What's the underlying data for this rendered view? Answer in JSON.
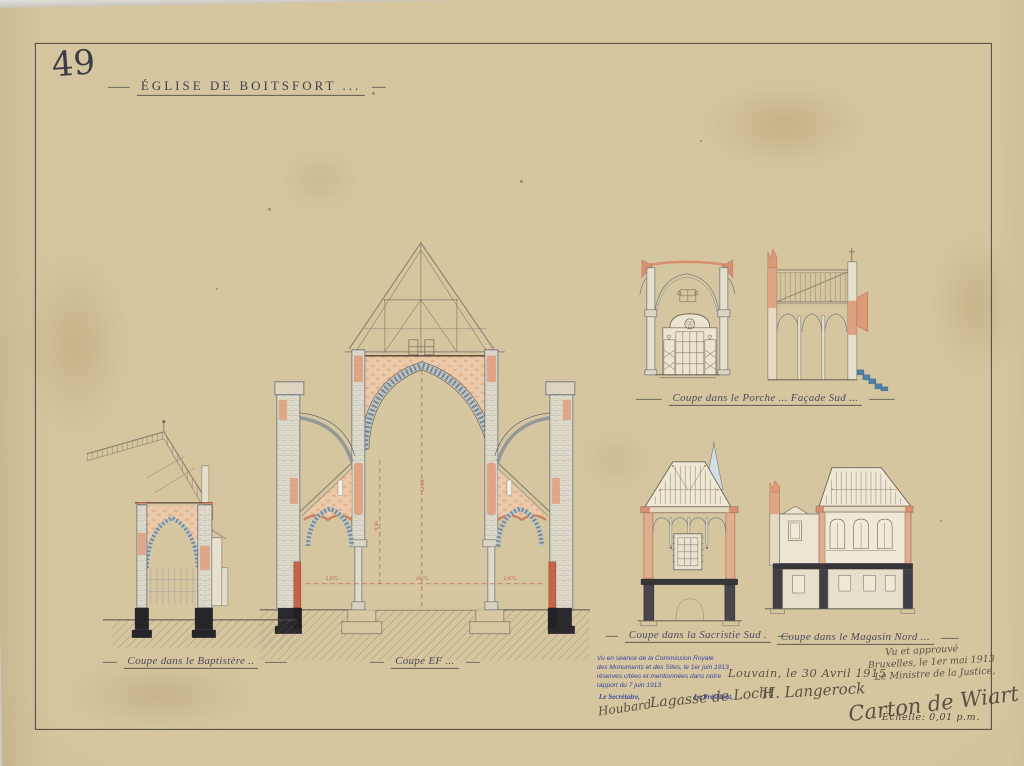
{
  "sheet": {
    "number": "49",
    "title": "Église de Boitsfort ...",
    "scale_label": "Échelle: 0,01 p.m."
  },
  "captions": {
    "baptistere": "Coupe dans le Baptistère ..",
    "coupe_ef": "Coupe EF ...",
    "porche": "Coupe dans le Porche ... Façade Sud ...",
    "sacristie": "Coupe dans la Sacristie Sud .",
    "magasin": "Coupe dans le Magasin Nord ..."
  },
  "dimensions": {
    "nave_left": "5,075",
    "nave_center": "10,75",
    "nave_right": "5,075",
    "aisle_height": "9,50",
    "nave_height": "12,60"
  },
  "stamp": {
    "line1": "Vu en séance de la Commission Royale",
    "line2": "des Monuments et des Sites, le 1er juin 1913",
    "line3": "réserves citées et mentionnées dans notre",
    "line4": "rapport du 7 juin 1913",
    "secretary_label": "Le Secrétaire,",
    "president_label": "Le Président,",
    "secretary_signature": "Houbard",
    "president_signature": "Lagasse de Locht"
  },
  "annotations": {
    "city_date": "Louvain, le 30 Avril 1915",
    "architect_signature": "H. Langerock",
    "approval_line1": "Vu et approuvé",
    "approval_line2": "Bruxelles, le 1er mai 1913",
    "approval_line3": "Le Ministre de la Justice,",
    "minister_signature": "Carton de Wiart"
  },
  "colors": {
    "paper": "#d6c6a0",
    "ink": "#4a4c5e",
    "masonry": "#65707d",
    "salmon": "#d98f72",
    "peach": "#ecc9a8",
    "black_foundation": "#2a2a2e",
    "red_dimension": "#bb5747",
    "stamp_blue": "#3b479f",
    "steps_blue": "#4e7fa8"
  }
}
